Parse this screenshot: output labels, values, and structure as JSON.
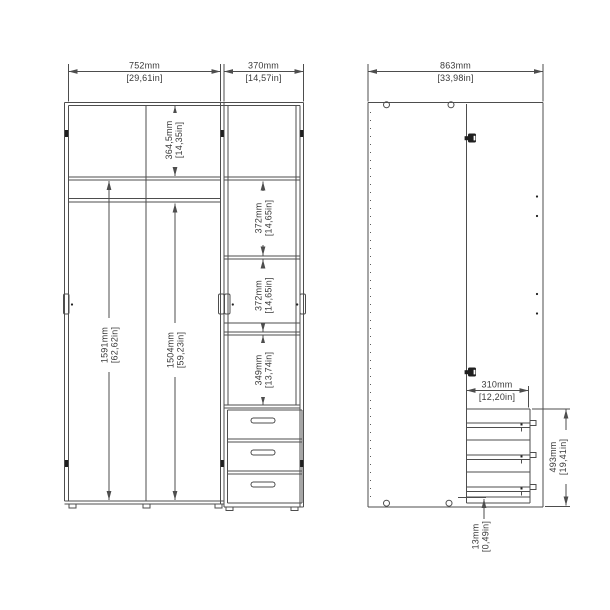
{
  "drawing": {
    "title": "wardrobe-assembly-dimension-drawing",
    "colors": {
      "line": "#4d4d4d",
      "text": "#3a3a3a",
      "background": "#ffffff"
    },
    "front_view": {
      "dims": {
        "width_left": {
          "mm": "752mm",
          "in": "[29,61in]"
        },
        "width_right": {
          "mm": "370mm",
          "in": "[14,57in]"
        },
        "top_compartment": {
          "mm": "364,5mm",
          "in": "[14,35in]"
        },
        "interior_left": {
          "mm": "1591mm",
          "in": "[62,62in]"
        },
        "interior_rod": {
          "mm": "1504mm",
          "in": "[59,23in]"
        },
        "shelf_1": {
          "mm": "372mm",
          "in": "[14,65in]"
        },
        "shelf_2": {
          "mm": "372mm",
          "in": "[14,65in]"
        },
        "shelf_3": {
          "mm": "349mm",
          "in": "[13,74in]"
        }
      }
    },
    "side_view": {
      "dims": {
        "width": {
          "mm": "863mm",
          "in": "[33,98in]"
        },
        "drawer_depth": {
          "mm": "310mm",
          "in": "[12,20in]"
        },
        "drawer_height": {
          "mm": "493mm",
          "in": "[19,41in]"
        },
        "base_gap": {
          "mm": "13mm",
          "in": "[0,49in]"
        }
      }
    }
  }
}
